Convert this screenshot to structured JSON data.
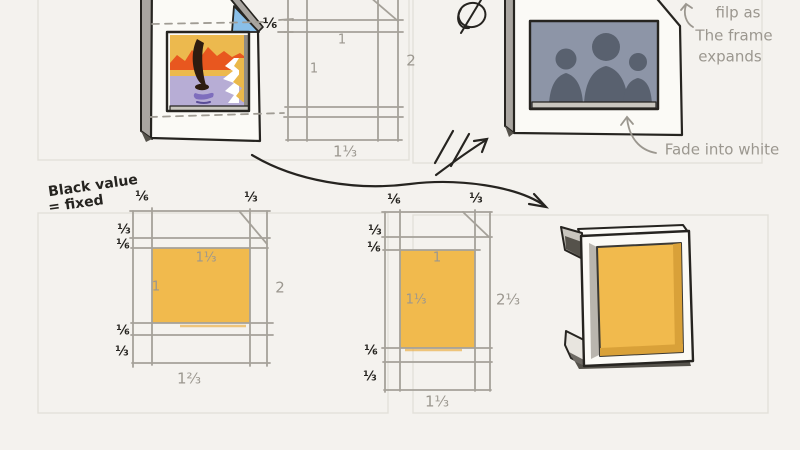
{
  "colors": {
    "background": "#f4f2ee",
    "ink_black": "#262420",
    "pencil_gray": "#9b978f",
    "grid_gray": "#a5a199",
    "panel_border": "#e3e0d9",
    "accent_orange": "#f1ba4d",
    "accent_orange_shade": "#d9a139",
    "page_curl_blue": "#8abfe8",
    "photo_background": "#8d95a7",
    "photo_silhouette": "#59616f"
  },
  "top_left_sketch": {
    "border_fraction": "⅙"
  },
  "top_middle_grid": {
    "width_label": "1",
    "height_label": "1",
    "right_total": "2",
    "bottom_total": "1⅓"
  },
  "top_right_sketch": {
    "flip_note": [
      "filp as",
      "The frame",
      "expands"
    ],
    "fade_note": "Fade into white"
  },
  "notes": {
    "black_value": [
      "Black value",
      "= fixed"
    ]
  },
  "bottom_left_grid": {
    "top_cols": [
      "⅙",
      "⅓"
    ],
    "left_rows": [
      "⅓",
      "⅙",
      "⅙",
      "⅓"
    ],
    "inner_width": "1⅓",
    "inner_height": "1",
    "right_total": "2",
    "bottom_total": "1⅔"
  },
  "bottom_middle_grid": {
    "top_cols": [
      "⅙",
      "⅓"
    ],
    "left_rows": [
      "⅓",
      "⅙",
      "⅙",
      "⅓"
    ],
    "inner_width": "1",
    "inner_height": "1⅓",
    "right_total": "2⅓",
    "bottom_total": "1⅓"
  }
}
